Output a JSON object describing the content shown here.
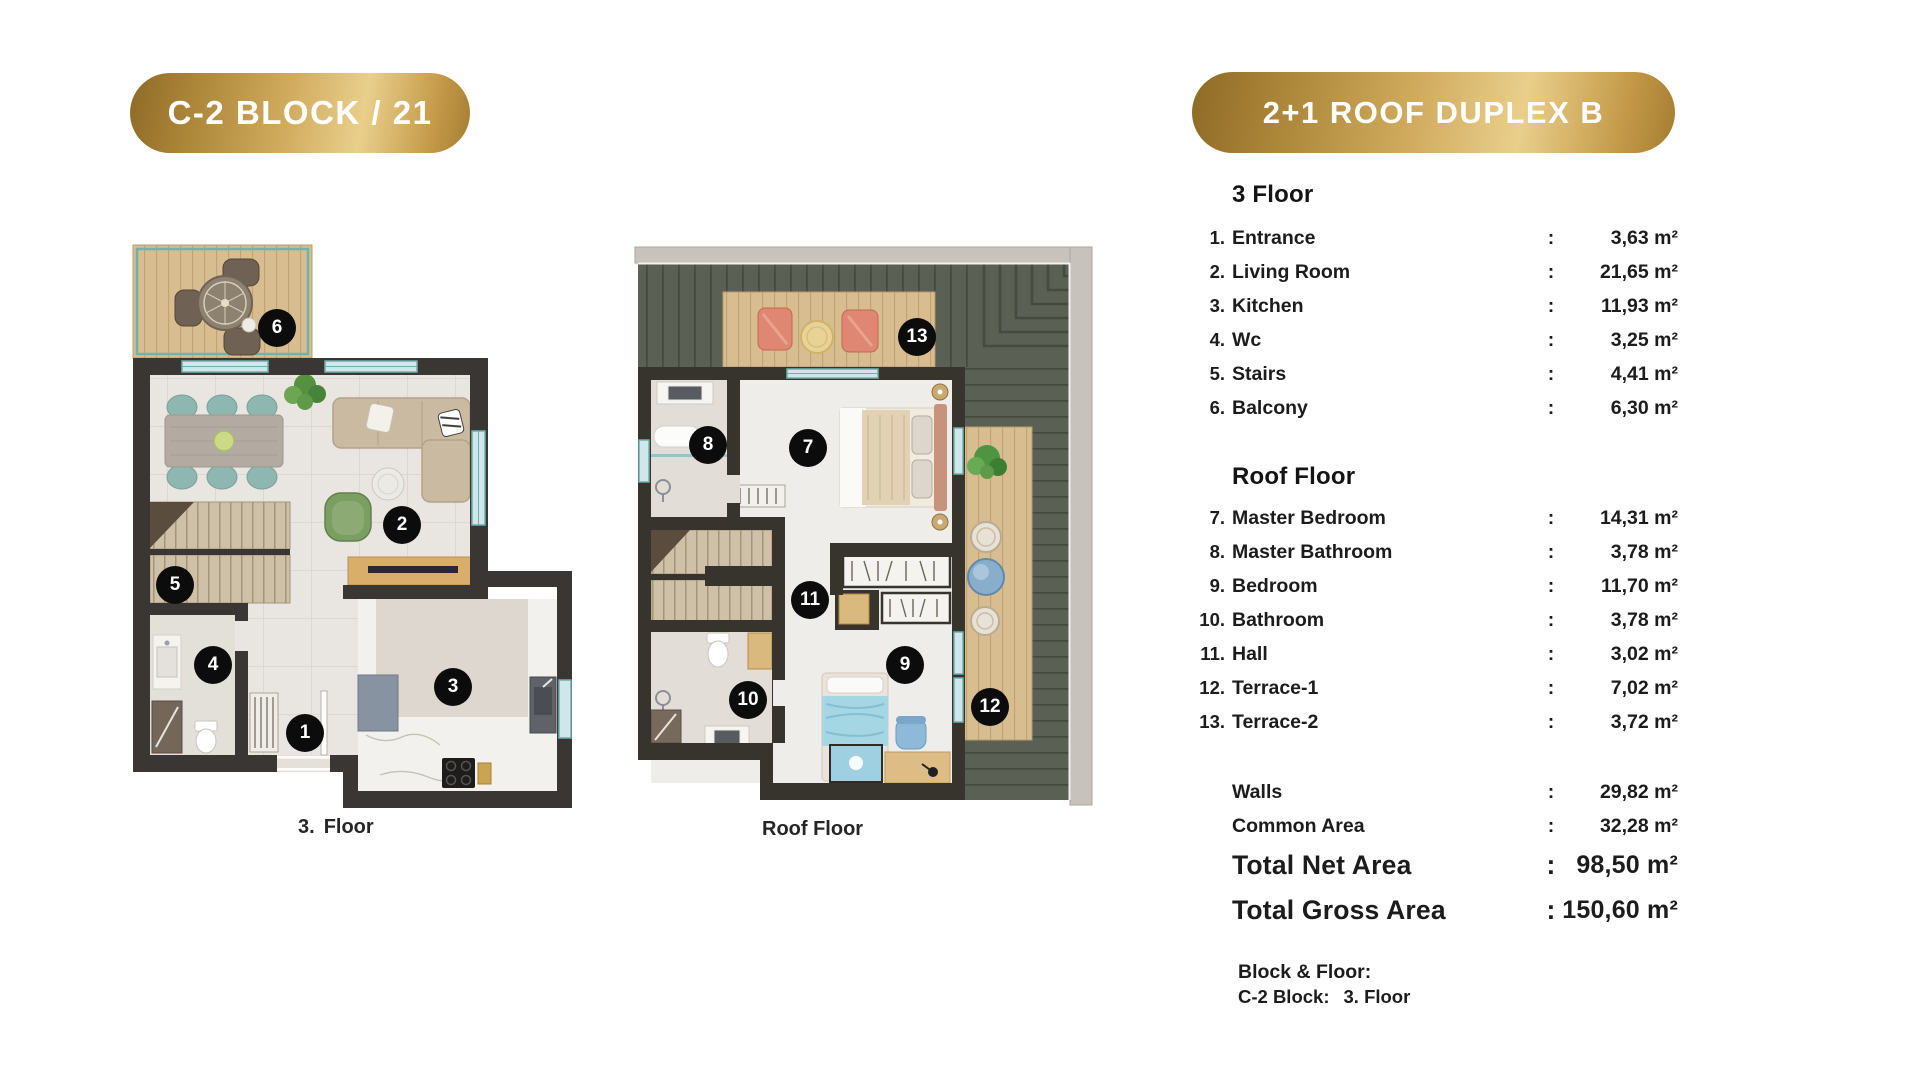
{
  "page": {
    "background": "#ffffff"
  },
  "left_badge": {
    "label": "C-2 BLOCK / 21"
  },
  "right_badge": {
    "label": "2+1 ROOF DUPLEX B"
  },
  "plans": {
    "floor3": {
      "caption_num": "3.",
      "caption_text": "Floor",
      "markers": [
        "1",
        "2",
        "3",
        "4",
        "5",
        "6"
      ]
    },
    "roof": {
      "caption": "Roof Floor",
      "markers": [
        "7",
        "8",
        "9",
        "10",
        "11",
        "12",
        "13"
      ]
    }
  },
  "area_table": {
    "colon": ":",
    "sections": [
      {
        "heading": "3 Floor",
        "items": [
          {
            "num": "1.",
            "label": "Entrance",
            "value": "3,63 m²"
          },
          {
            "num": "2.",
            "label": "Living Room",
            "value": "21,65 m²"
          },
          {
            "num": "3.",
            "label": "Kitchen",
            "value": "11,93 m²"
          },
          {
            "num": "4.",
            "label": "Wc",
            "value": "3,25 m²"
          },
          {
            "num": "5.",
            "label": "Stairs",
            "value": "4,41 m²"
          },
          {
            "num": "6.",
            "label": "Balcony",
            "value": "6,30 m²"
          }
        ]
      },
      {
        "heading": "Roof Floor",
        "items": [
          {
            "num": "7.",
            "label": "Master Bedroom",
            "value": "14,31 m²"
          },
          {
            "num": "8.",
            "label": "Master Bathroom",
            "value": "3,78 m²"
          },
          {
            "num": "9.",
            "label": "Bedroom",
            "value": "11,70 m²"
          },
          {
            "num": "10.",
            "label": "Bathroom",
            "value": "3,78 m²"
          },
          {
            "num": "11.",
            "label": "Hall",
            "value": "3,02 m²"
          },
          {
            "num": "12.",
            "label": "Terrace-1",
            "value": "7,02 m²"
          },
          {
            "num": "13.",
            "label": "Terrace-2",
            "value": "3,72 m²"
          }
        ]
      }
    ],
    "summary": [
      {
        "label": "Walls",
        "value": "29,82 m²"
      },
      {
        "label": "Common Area",
        "value": "32,28 m²"
      },
      {
        "label": "Total Net Area",
        "value": "98,50 m²"
      },
      {
        "label": "Total Gross Area",
        "value": "150,60 m²"
      }
    ],
    "block_floor": {
      "title": "Block & Floor:",
      "block": "C-2 Block:",
      "floor": "3. Floor"
    }
  },
  "colors": {
    "gold_dark": "#96702a",
    "gold_light": "#e8cd87",
    "badge_text": "#ffffff",
    "text": "#1c1c1c",
    "marker_bg": "#0c0c0c",
    "marker_text": "#ffffff",
    "wall": "#3a3633",
    "roof_green": "#5b6055",
    "deck_wood": "#d8bd90",
    "window_teal": "#6fb0ac",
    "floor_tile": "#e9e6e1",
    "accent_coral": "#df8773",
    "accent_blue": "#a5d6e4"
  }
}
